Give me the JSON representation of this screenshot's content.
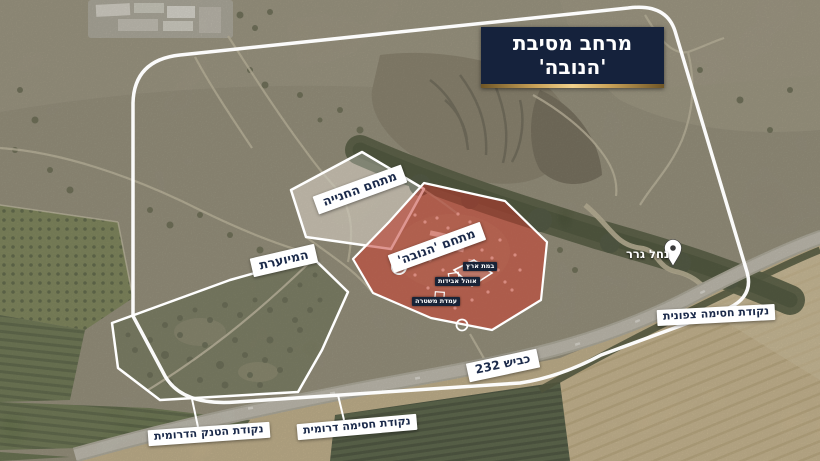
{
  "title": "מרחב מסיבת 'הנובה'",
  "labels": {
    "parking_area": "מתחם החנייה",
    "nova_compound": "מתחם 'הנובה'",
    "wooded_area": "המיוערת",
    "road_232": "כביש 232",
    "nahal_gerar": "נחל גרר",
    "north_block_point": "נקודת חסימה צפונית",
    "south_block_point": "נקודת חסימה דרומית",
    "south_tank_point": "נקודת הטנק הדרומית"
  },
  "micro_labels": {
    "stage": "במת ארץ",
    "lost_and_found": "אוהל אבידות",
    "police_post": "עמדת משטרה"
  },
  "icons": {
    "location_pin": "map-pin"
  },
  "colors": {
    "title_bg": "#15223c",
    "title_text": "#ffffff",
    "gold_accent": "#d9b36a",
    "label_bg": "#ffffff",
    "label_text": "#1b2a4a",
    "nova_overlay": "#c0352d",
    "parking_overlay": "rgba(255,255,255,0.26)",
    "outline_white": "#ffffff"
  }
}
